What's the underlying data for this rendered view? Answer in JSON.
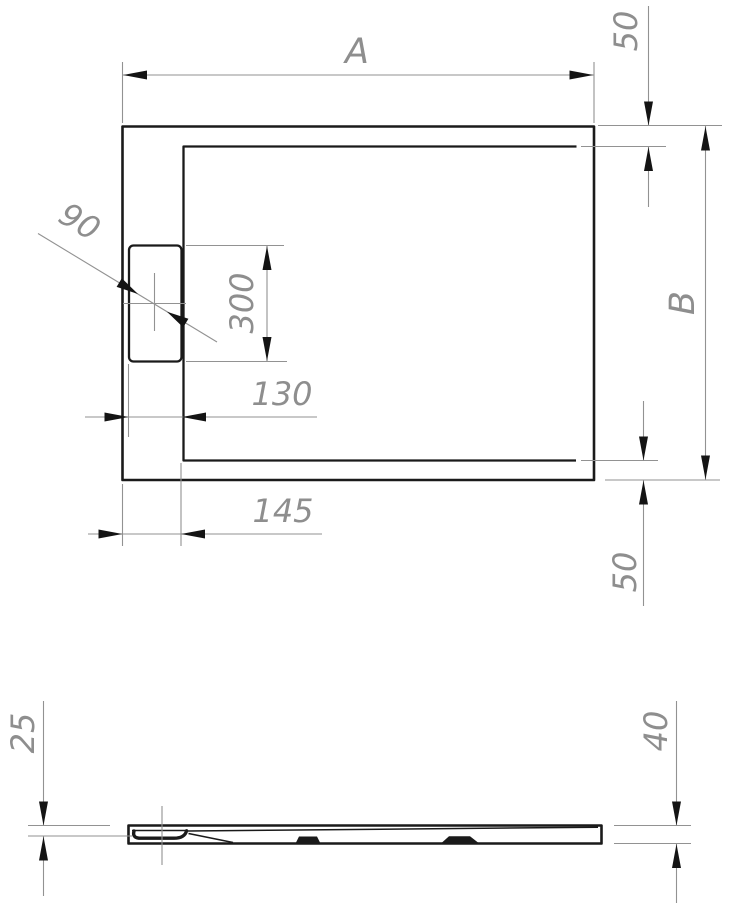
{
  "drawing": {
    "colors": {
      "background": "#ffffff",
      "geometry": "#1a1a1a",
      "dimension_lines": "#929292",
      "arrowheads": "#141414",
      "dimension_text": "#8e8e8e"
    },
    "dimensions": {
      "overall_width_label": "A",
      "overall_depth_label": "B",
      "rim_top_right": "50",
      "rim_bottom_right": "50",
      "drain_diameter": "90",
      "drain_slot_length": "300",
      "drain_to_inner_wall": "130",
      "outer_to_inner_wall": "145",
      "drain_recess_depth": "25",
      "tray_height": "40"
    }
  }
}
